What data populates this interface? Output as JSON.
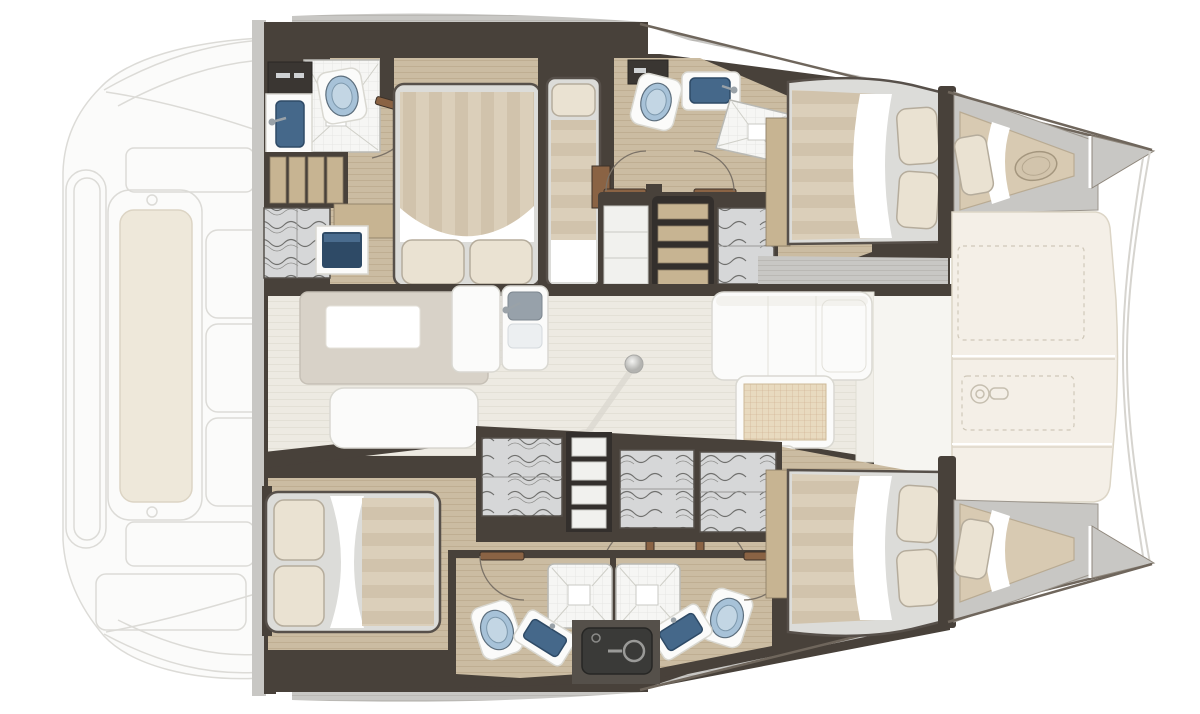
{
  "document": {
    "kind": "boat-interior-floor-plan",
    "vessel": "sailing-catamaran",
    "orientation": "bow-right-stern-left",
    "visible_text": []
  },
  "areas": {
    "aft_deck_ghost": {
      "items": [
        "swim-platform",
        "cockpit-bench",
        "backrest-panels",
        "deck-outline"
      ]
    },
    "port_hull": {
      "aft_head": {
        "items": [
          "storage-cabinet",
          "washbasin",
          "toilet",
          "shower",
          "door"
        ]
      },
      "aft_cabin": {
        "items": [
          "double-bed",
          "two-pillows",
          "steps",
          "hanging-locker",
          "tv-screen",
          "side-table"
        ]
      },
      "mid_cabin": {
        "items": [
          "single-bed",
          "pillow",
          "locker"
        ]
      },
      "mid_head": {
        "items": [
          "toilet",
          "washbasin",
          "shower",
          "double-door"
        ]
      },
      "companionway": {
        "items": [
          "shelves",
          "stairs",
          "hanging-locker"
        ]
      },
      "forward_cabin": {
        "items": [
          "double-bed",
          "two-pillows",
          "walkway"
        ]
      },
      "forepeak": {
        "items": [
          "crew-berth",
          "pillow",
          "deck-hatch"
        ]
      }
    },
    "saloon": {
      "galley": {
        "items": [
          "counter",
          "worktop-inset",
          "bench",
          "island-unit",
          "double-sink",
          "faucet"
        ]
      },
      "dining": {
        "items": [
          "l-shaped-sofa",
          "chaise",
          "rattan-table",
          "bench",
          "stool",
          "table-leg"
        ]
      }
    },
    "foredeck": {
      "items": [
        "deck-panels",
        "hatch-outline-dashed",
        "windlass",
        "bow-tips"
      ]
    },
    "starboard_hull": {
      "aft_cabin": {
        "items": [
          "double-bed",
          "two-pillows",
          "double-door"
        ]
      },
      "wardrobe_row": {
        "items": [
          "hanging-locker",
          "shelf-unit",
          "hanging-locker",
          "hanging-locker"
        ]
      },
      "bathrooms": {
        "items": [
          "shower",
          "shower",
          "toilet",
          "toilet",
          "washbasin",
          "washbasin",
          "technical-unit",
          "doors"
        ]
      },
      "forward_cabin": {
        "items": [
          "double-bed",
          "two-pillows",
          "walkway"
        ]
      },
      "forepeak": {
        "items": [
          "crew-berth",
          "pillow"
        ]
      }
    }
  },
  "colors": {
    "wall_dark": "#48413a",
    "wall_mid": "#6d6157",
    "wood_floor": "#cbbca2",
    "wood_line": "#bfae92",
    "wood_step": "#c7b492",
    "saloon_floor": "#edeae2",
    "saloon_line": "#e3e0d6",
    "deck_gray": "#c8c7c4",
    "deck_line": "#bab8b4",
    "cream_deck": "#f4efe7",
    "cream_line": "#dcd5c6",
    "stripe_a": "#dbcfba",
    "stripe_b": "#d1c3ac",
    "pillow": "#eae2d2",
    "pillow_edge": "#b5ac9c",
    "mattress": "#dcdcd9",
    "toilet_blue": "#a7c2d8",
    "basin_blue": "#45688a",
    "fixture_white": "#fbfbfa",
    "furniture_line": "#d9d8d1",
    "tile_line": "#cfcfc8",
    "clothes_bg": "#d6d7d8",
    "clothes_line": "#70706e",
    "shelf_white": "#f1f1ee",
    "door_wood": "#8a6344",
    "arc_line": "#7b7267",
    "ghost_line": "#dcdbd7",
    "ghost_fill": "#fbfbfa",
    "bench_cream": "#eee8da",
    "equip_dark": "#3a3a38",
    "equip_base": "#55504a",
    "grid_bg": "#e8dabf",
    "grid_line": "#cdad8b",
    "dark_cabinet": "#3a3632",
    "hull_line": "#6f665c",
    "screen_navy": "#2e4a66"
  }
}
